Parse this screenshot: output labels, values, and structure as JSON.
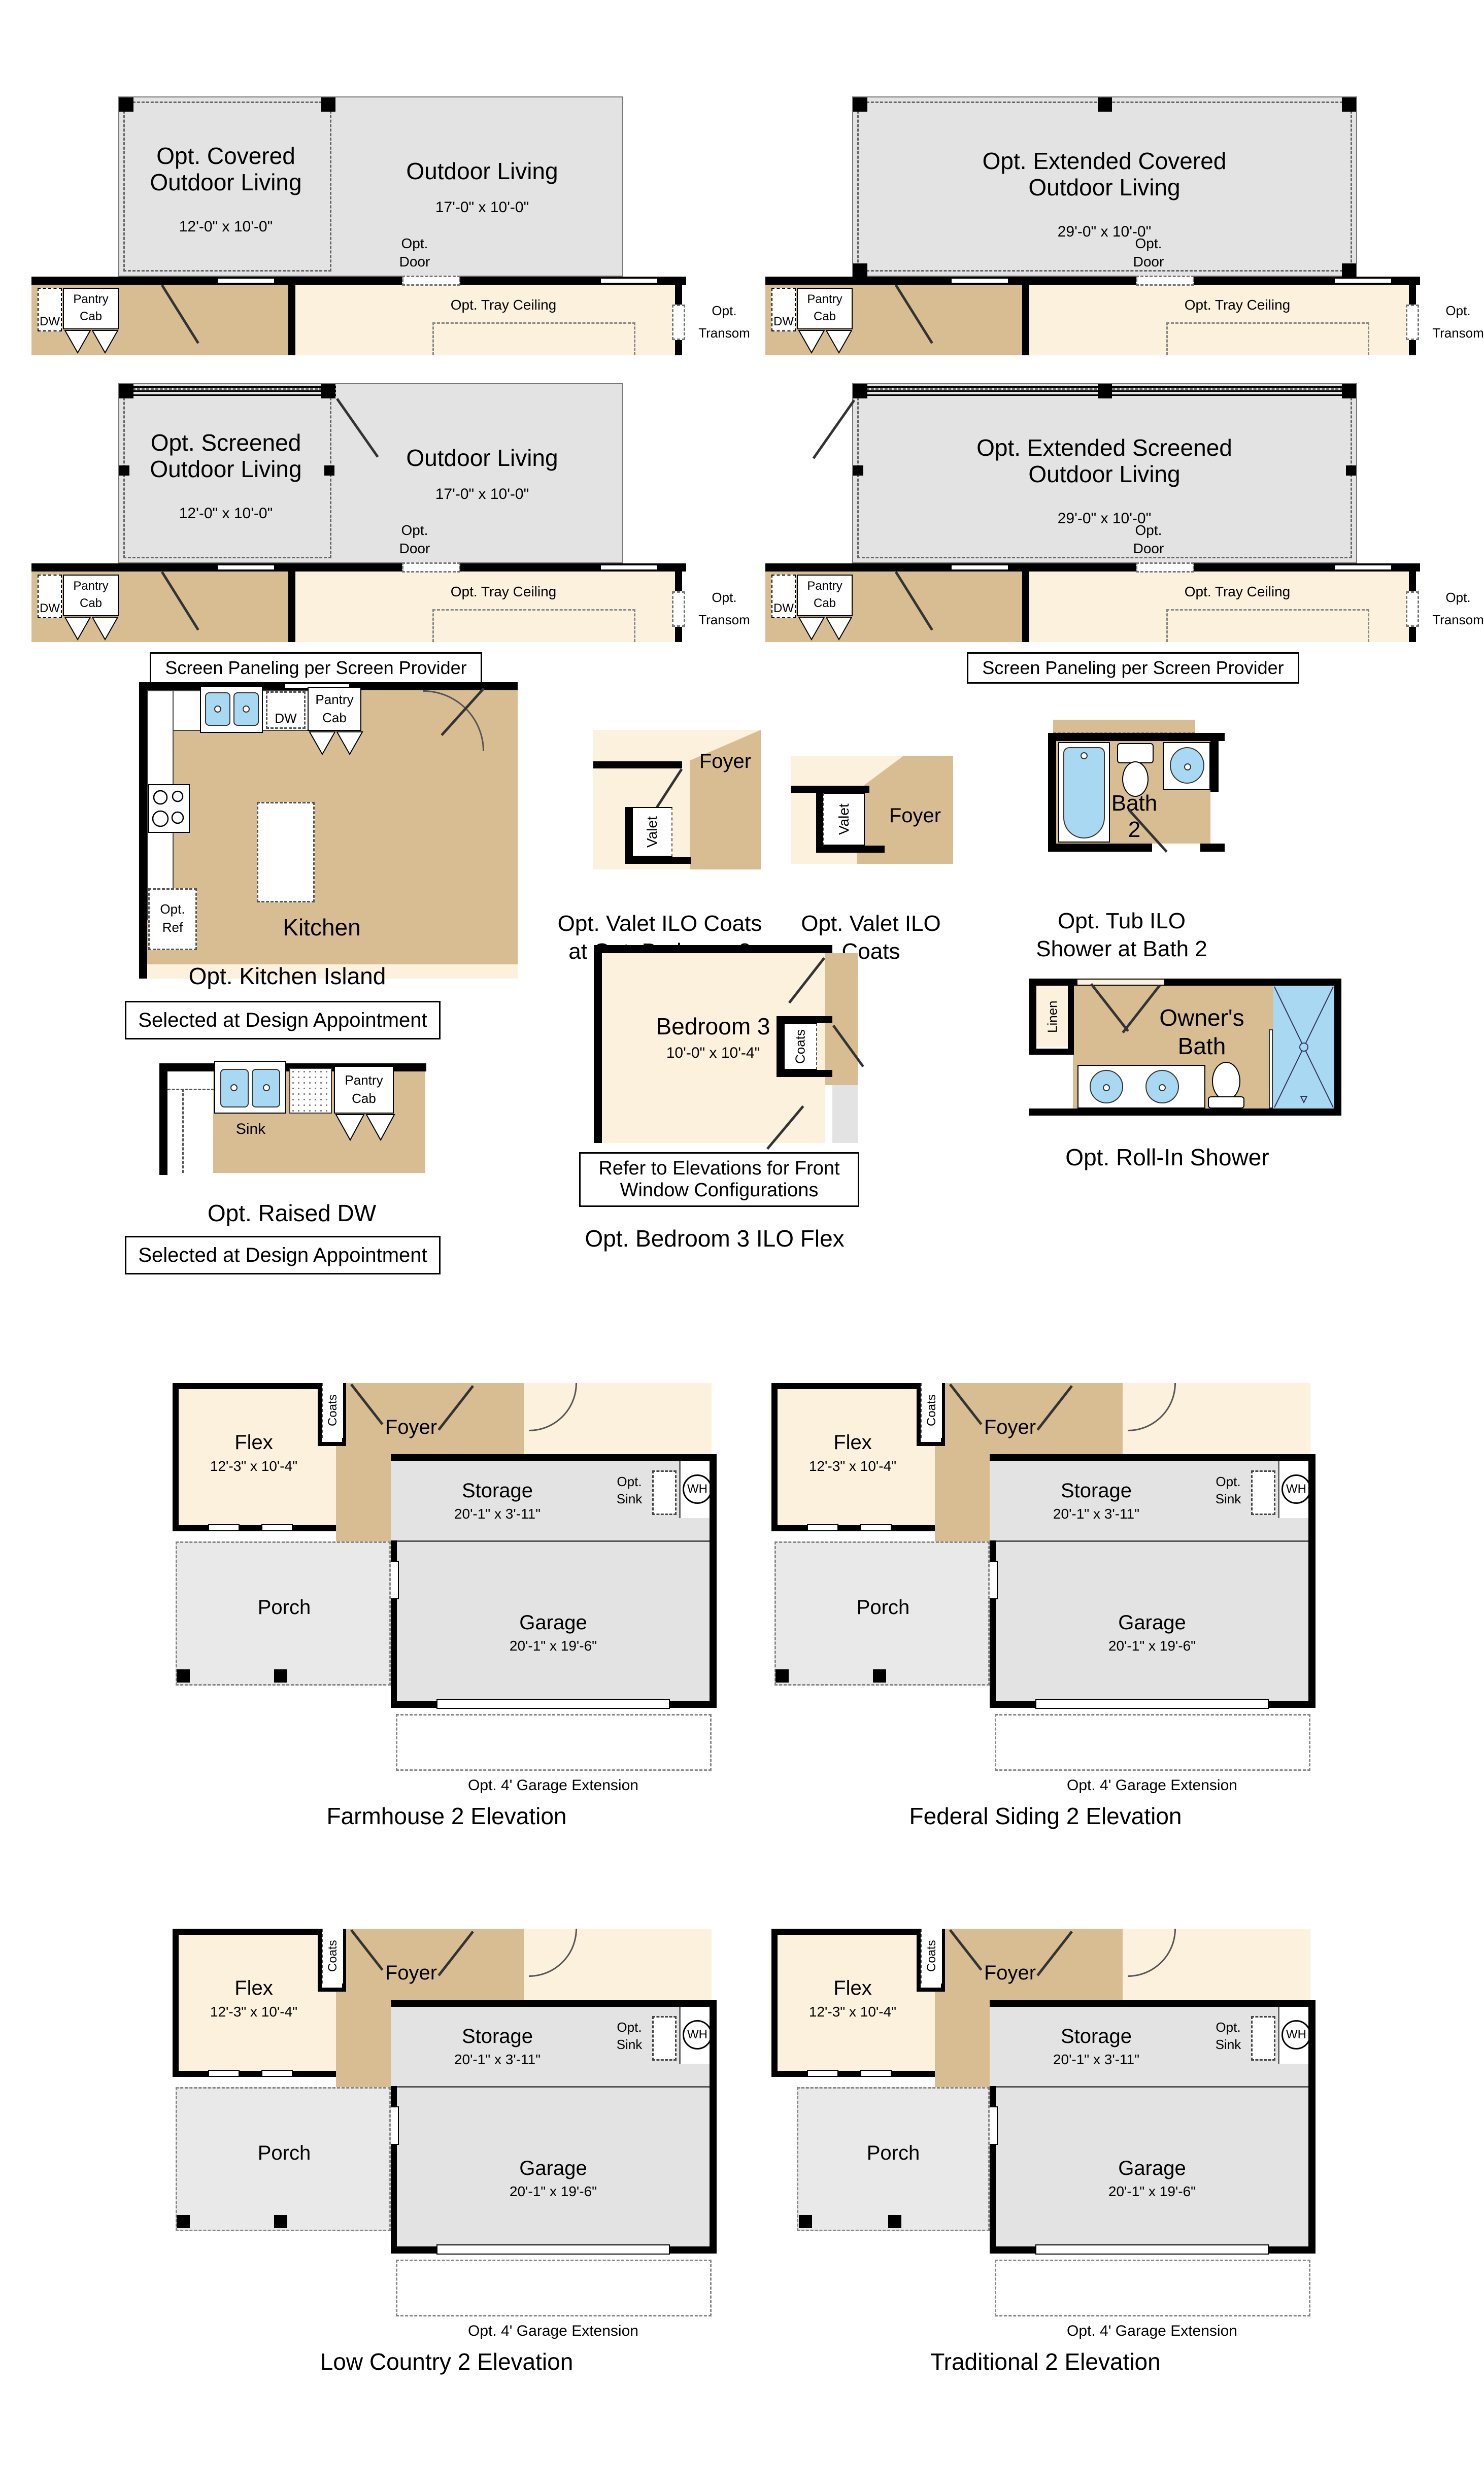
{
  "colors": {
    "tan": "#d8bd93",
    "cream": "#fbf1dc",
    "gray": "#e3e3e3",
    "porch_gray": "#e9e9e9",
    "fixture_blue": "#a9d9f2",
    "wall_black": "#000000"
  },
  "common": {
    "dw": "DW",
    "pantry_l1": "Pantry",
    "pantry_l2": "Cab",
    "opt_door_l1": "Opt.",
    "opt_door_l2": "Door",
    "opt_tray": "Opt. Tray Ceiling",
    "opt_transom_l1": "Opt.",
    "opt_transom_l2": "Transom",
    "outdoor_living": "Outdoor Living",
    "outdoor_living_dims": "17'-0\" x 10'-0\"",
    "screen_note": "Screen Paneling per Screen Provider",
    "selected_note": "Selected at Design Appointment"
  },
  "covered": {
    "title": "Opt. Covered Outdoor Living",
    "dims": "12'-0\" x 10'-0\""
  },
  "extended_covered": {
    "title": "Opt. Extended Covered Outdoor Living",
    "dims": "29'-0\" x 10'-0\""
  },
  "screened": {
    "title": "Opt. Screened Outdoor Living",
    "dims": "12'-0\" x 10'-0\""
  },
  "extended_screened": {
    "title": "Opt. Extended Screened Outdoor Living",
    "dims": "29'-0\" x 10'-0\""
  },
  "kitchen": {
    "room": "Kitchen",
    "opt_ref_l1": "Opt.",
    "opt_ref_l2": "Ref",
    "caption": "Opt. Kitchen Island"
  },
  "valet_bed3": {
    "foyer": "Foyer",
    "valet": "Valet",
    "caption_l1": "Opt. Valet ILO Coats",
    "caption_l2": "at Opt. Bedroom 3"
  },
  "valet_coats": {
    "foyer": "Foyer",
    "valet": "Valet",
    "caption_l1": "Opt. Valet ILO",
    "caption_l2": "Coats"
  },
  "bath2": {
    "room_l1": "Bath",
    "room_l2": "2",
    "caption_l1": "Opt. Tub ILO",
    "caption_l2": "Shower at Bath 2"
  },
  "bedroom3": {
    "room": "Bedroom 3",
    "dims": "10'-0\" x 10'-4\"",
    "coats": "Coats",
    "note_l1": "Refer to Elevations for Front",
    "note_l2": "Window Configurations",
    "caption": "Opt. Bedroom 3 ILO Flex"
  },
  "owners_bath": {
    "room_l1": "Owner's",
    "room_l2": "Bath",
    "linen": "Linen",
    "caption": "Opt. Roll-In Shower"
  },
  "raised_dw": {
    "sink": "Sink",
    "caption": "Opt. Raised DW"
  },
  "elevation": {
    "flex": "Flex",
    "flex_dims": "12'-3\" x 10'-4\"",
    "coats": "Coats",
    "foyer": "Foyer",
    "storage": "Storage",
    "storage_dims": "20'-1\" x 3'-11\"",
    "opt_sink_l1": "Opt.",
    "opt_sink_l2": "Sink",
    "wh": "WH",
    "porch": "Porch",
    "garage": "Garage",
    "garage_dims": "20'-1\" x 19'-6\"",
    "extension": "Opt. 4' Garage Extension"
  },
  "elevation_names": {
    "farmhouse": "Farmhouse 2 Elevation",
    "federal": "Federal Siding 2 Elevation",
    "low_country": "Low Country 2 Elevation",
    "traditional": "Traditional 2 Elevation"
  }
}
